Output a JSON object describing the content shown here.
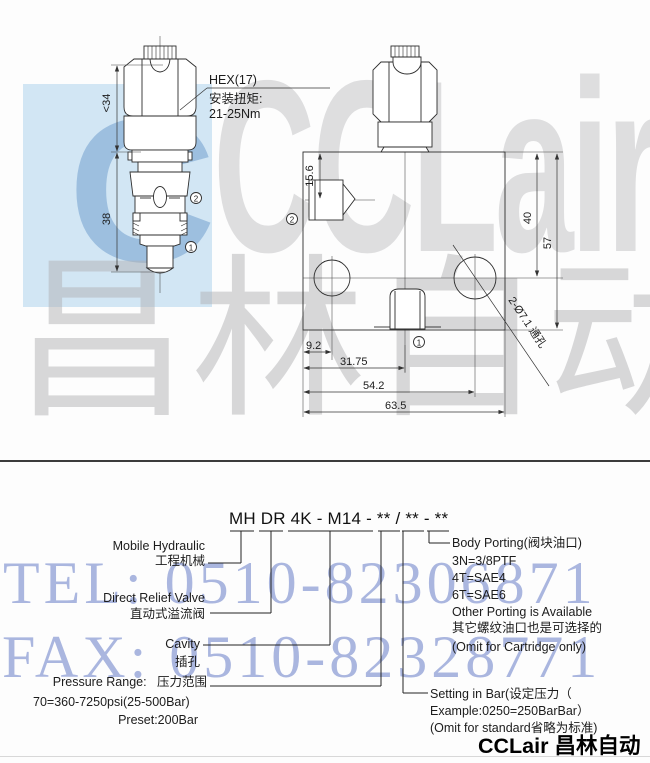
{
  "watermarks": {
    "logo_c": "C",
    "logo_text": "CCLair",
    "logo_text_zh": "昌林自动化",
    "tel": "TEL: 0510-82306871",
    "fax": "FAX: 0510-82328771",
    "accent_blue": "#b5d7ee",
    "phone_blue": "#96a5d8",
    "gray": "#c5c5c8"
  },
  "left_drawing": {
    "dim_upper": "<34",
    "dim_lower": "38",
    "hex_label": "HEX(17)",
    "torque_zh": "安装扭矩:",
    "torque_value": "21-25Nm",
    "port_upper": "2",
    "port_lower": "1"
  },
  "right_drawing": {
    "dim_side": "15.6",
    "dim_40": "40",
    "dim_57": "57",
    "dim_9_2": "9.2",
    "dim_31_75": "31.75",
    "dim_54_2": "54.2",
    "dim_63_5": "63.5",
    "holes_label": "2-Ø7.1 通孔",
    "port_side": "2",
    "port_bottom": "1"
  },
  "model_code": {
    "code": "MH DR 4K - M14 - ** / ** - **"
  },
  "legend": {
    "mobile_hydraulic_en": "Mobile Hydraulic",
    "mobile_hydraulic_zh": "工程机械",
    "direct_relief_en": "Direct Relief Valve",
    "direct_relief_zh": "直动式溢流阀",
    "cavity_en": "Cavity",
    "cavity_zh": "插孔",
    "pressure_range": "Pressure Range:   压力范围",
    "pressure_line1": "70=360-7250psi(25-500Bar)",
    "pressure_line2": "Preset:200Bar",
    "body_porting_lines": [
      "Body Porting(阀块油口)",
      "3N=3/8PTF",
      "4T=SAE4",
      "6T=SAE6",
      "Other Porting is Available",
      "其它螺纹油口也是可选择的",
      "(Omit for Cartridge only)"
    ],
    "setting_lines": [
      "Setting in Bar(设定压力（",
      "Example:0250=250BarBar）",
      "(Omit for standard省略为标准)"
    ]
  },
  "footer": {
    "logo": "CCLair 昌林自动化"
  }
}
